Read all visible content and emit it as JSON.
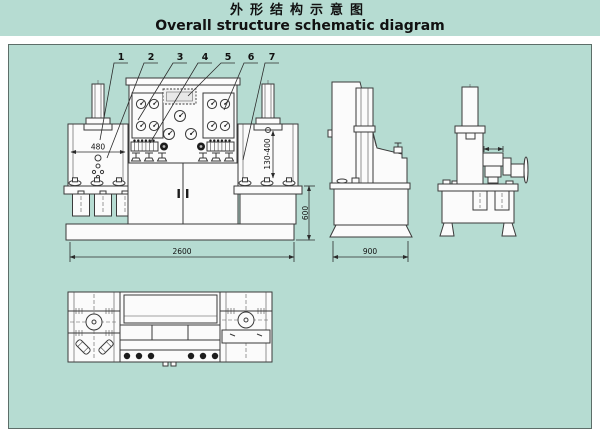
{
  "title": {
    "zh": "外形结构示意图",
    "en": "Overall structure schematic diagram"
  },
  "callouts": [
    "1",
    "2",
    "3",
    "4",
    "5",
    "6",
    "7"
  ],
  "dimensions": {
    "overall_width": "2600",
    "overall_depth": "900",
    "base_height": "600",
    "left_stand_width": "480",
    "right_stand_range": "130-400"
  },
  "colors": {
    "background": "#b6dcd2",
    "line": "#3a3a3a",
    "panel_border": "#5d6e69",
    "fill": "#fbfbfb"
  }
}
